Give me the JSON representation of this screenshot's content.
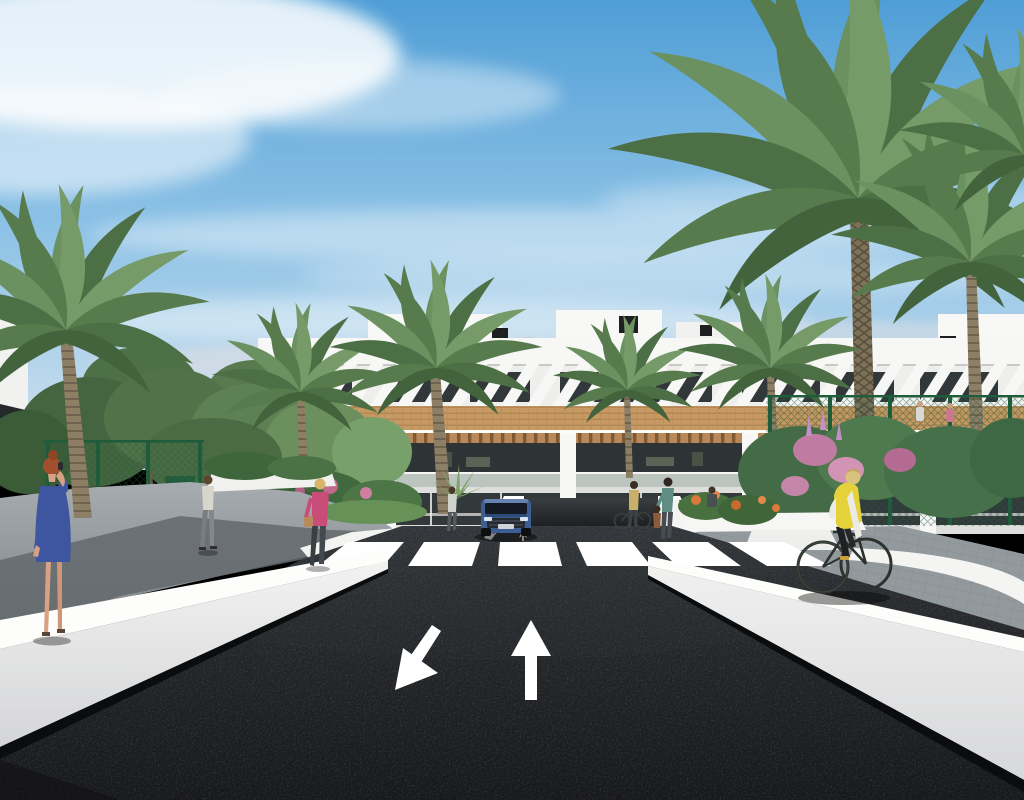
{
  "scene": {
    "kind": "3D architectural rendering",
    "view": "street approach to a modern white apartment complex with palm trees"
  },
  "sky": {
    "top": "#4f9ed6",
    "mid": "#8fc3e6",
    "horizon": "#d3e3ee",
    "cloud": "#ffffff"
  },
  "building": {
    "facade": "#f3f3f1",
    "parapet": "#f7f7f5",
    "wood_band": "#c79a63",
    "window_dark": "#32373a",
    "glass_rail": "#8fa099",
    "pergola_wood": "#b9895a",
    "features": [
      "rooftop pergola slats",
      "roof parasols",
      "wood cladding band",
      "two balcony floors",
      "underground garage ramp"
    ]
  },
  "ground": {
    "road": "#222426",
    "sidewalk": "#979da1",
    "wall_white": "#eceded",
    "marking_white": "#ffffff"
  },
  "road_markings": {
    "crosswalk_stripes": 6,
    "lane_arrows": [
      {
        "id": "left-lane-arrow",
        "direction": "toward viewer (down-left)"
      },
      {
        "id": "right-lane-arrow",
        "direction": "away from viewer (up)"
      }
    ],
    "ramp_arrows": 2
  },
  "vegetation": {
    "palm": "#5c7f52",
    "palm_light": "#729566",
    "tree": "#4e7247",
    "flowers_pink": "#c983ab",
    "flowers_orange": "#d9793b",
    "fence_green": "#1f5c3b"
  },
  "vehicles": {
    "car": {
      "type": "SUV",
      "color": "#3c5e93",
      "location": "entering garage ramp"
    },
    "bicycle_riding": {
      "rider_vest": "#e5d23a",
      "location": "right sidewalk"
    },
    "bicycle_standing": {
      "location": "right of garage ramp"
    }
  },
  "people": [
    {
      "id": "woman-blue-dress",
      "hair": "#a14f2c",
      "dress": "#3e56a0",
      "location": "left sidewalk, on phone"
    },
    {
      "id": "man-walking",
      "shirt": "#d8d5cc",
      "location": "left path"
    },
    {
      "id": "woman-pink-top",
      "top": "#c84d78",
      "location": "left walkway, carrying handbag"
    },
    {
      "id": "woman-by-ramp",
      "top": "#cfd3cc",
      "location": "left of garage ramp"
    },
    {
      "id": "woman-with-bicycle",
      "top": "#c9b06a",
      "location": "right of ramp"
    },
    {
      "id": "woman-with-child",
      "top": "#5f8d84",
      "location": "right of ramp"
    },
    {
      "id": "child",
      "top": "#8a5a3c",
      "location": "right of ramp"
    },
    {
      "id": "cyclist",
      "vest": "#e5d23a",
      "location": "right sidewalk"
    }
  ]
}
